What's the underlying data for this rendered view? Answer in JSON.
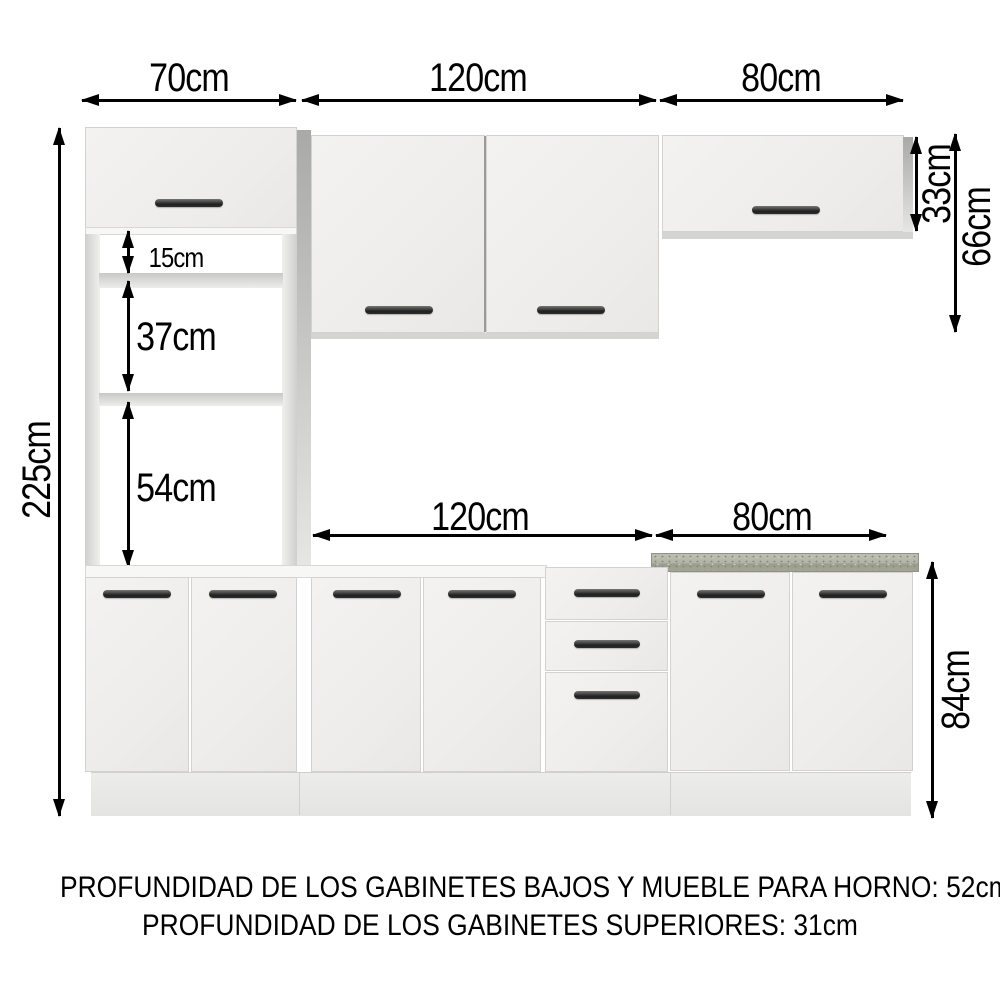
{
  "diagram": {
    "type": "kitchen-cabinet-dimension-diagram",
    "dims": {
      "top_width_left": "70cm",
      "top_width_mid": "120cm",
      "top_width_right": "80cm",
      "height_total": "225cm",
      "opening_top": "15cm",
      "opening_mid": "37cm",
      "opening_bottom": "54cm",
      "upper_right_height": "33cm",
      "upper_height": "66cm",
      "base_width_mid": "120cm",
      "base_width_right": "80cm",
      "base_height": "84cm"
    },
    "footer": {
      "line1": "PROFUNDIDAD DE LOS GABINETES BAJOS Y MUEBLE PARA HORNO: 52cm",
      "line2": "PROFUNDIDAD DE LOS GABINETES SUPERIORES: 31cm"
    },
    "colors": {
      "background": "#ffffff",
      "cabinet_face": "#f0efee",
      "cabinet_border": "#d3d2d0",
      "side_panel": "#b5b5b3",
      "handle": "#262726",
      "countertop": "#afb2a4",
      "dimension_lines": "#000000"
    }
  }
}
